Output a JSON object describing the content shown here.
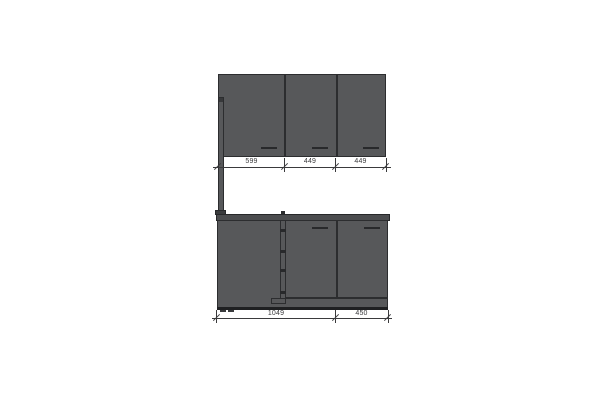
{
  "drawing": {
    "kind": "kitchen cabinet elevation",
    "colors": {
      "cabinet_fill": "#57585a",
      "countertop_fill": "#4b4c4e",
      "outline": "#2c2d2f",
      "dimension_color": "#3a3a3c",
      "background": "#ffffff"
    },
    "wall_cabinets": {
      "dimensions": [
        "599",
        "449",
        "449"
      ]
    },
    "base_cabinets": {
      "dimensions": [
        "1049",
        "450"
      ]
    }
  }
}
